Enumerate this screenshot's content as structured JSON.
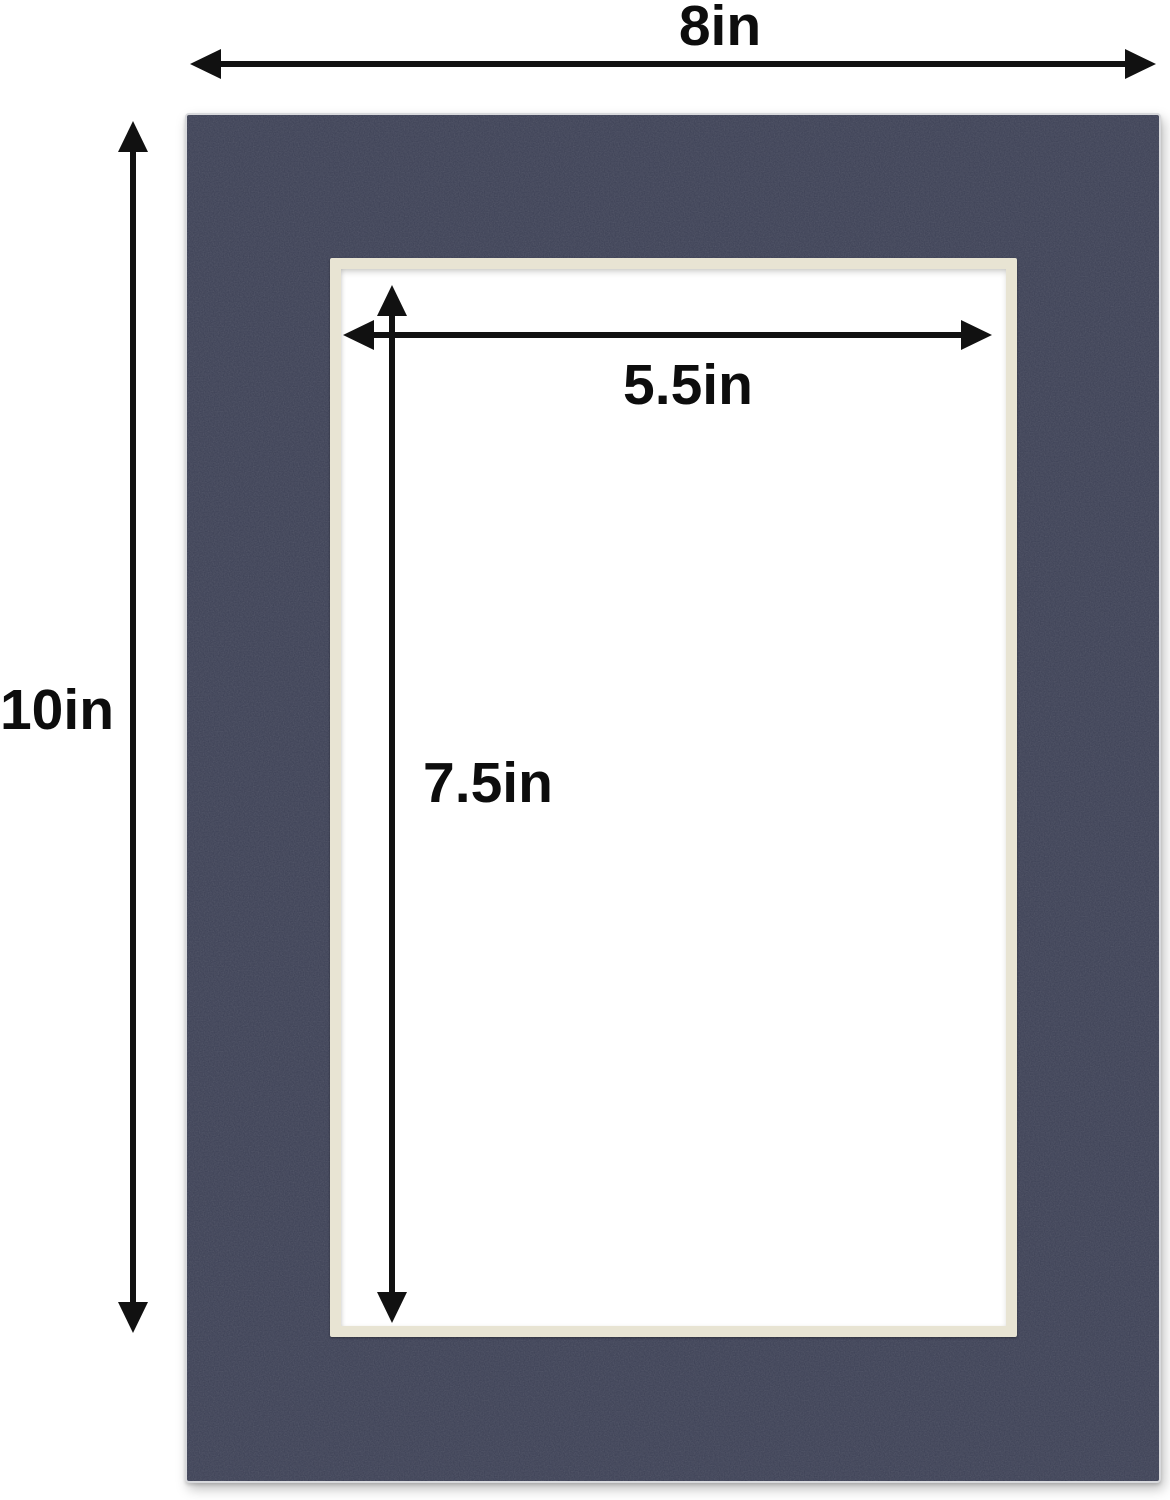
{
  "diagram": {
    "title": "mat-board-dimension-diagram",
    "labels": {
      "outer_width": "8in",
      "outer_height": "10in",
      "opening_width": "5.5in",
      "opening_height": "7.5in"
    },
    "dimensions": {
      "outer": {
        "width_in": 8,
        "height_in": 10
      },
      "opening": {
        "width_in": 5.5,
        "height_in": 7.5
      }
    },
    "colors": {
      "mat": "#3b3f54",
      "bevel": "#e8e4d3",
      "background": "#ffffff",
      "annotation": "#111111"
    }
  }
}
